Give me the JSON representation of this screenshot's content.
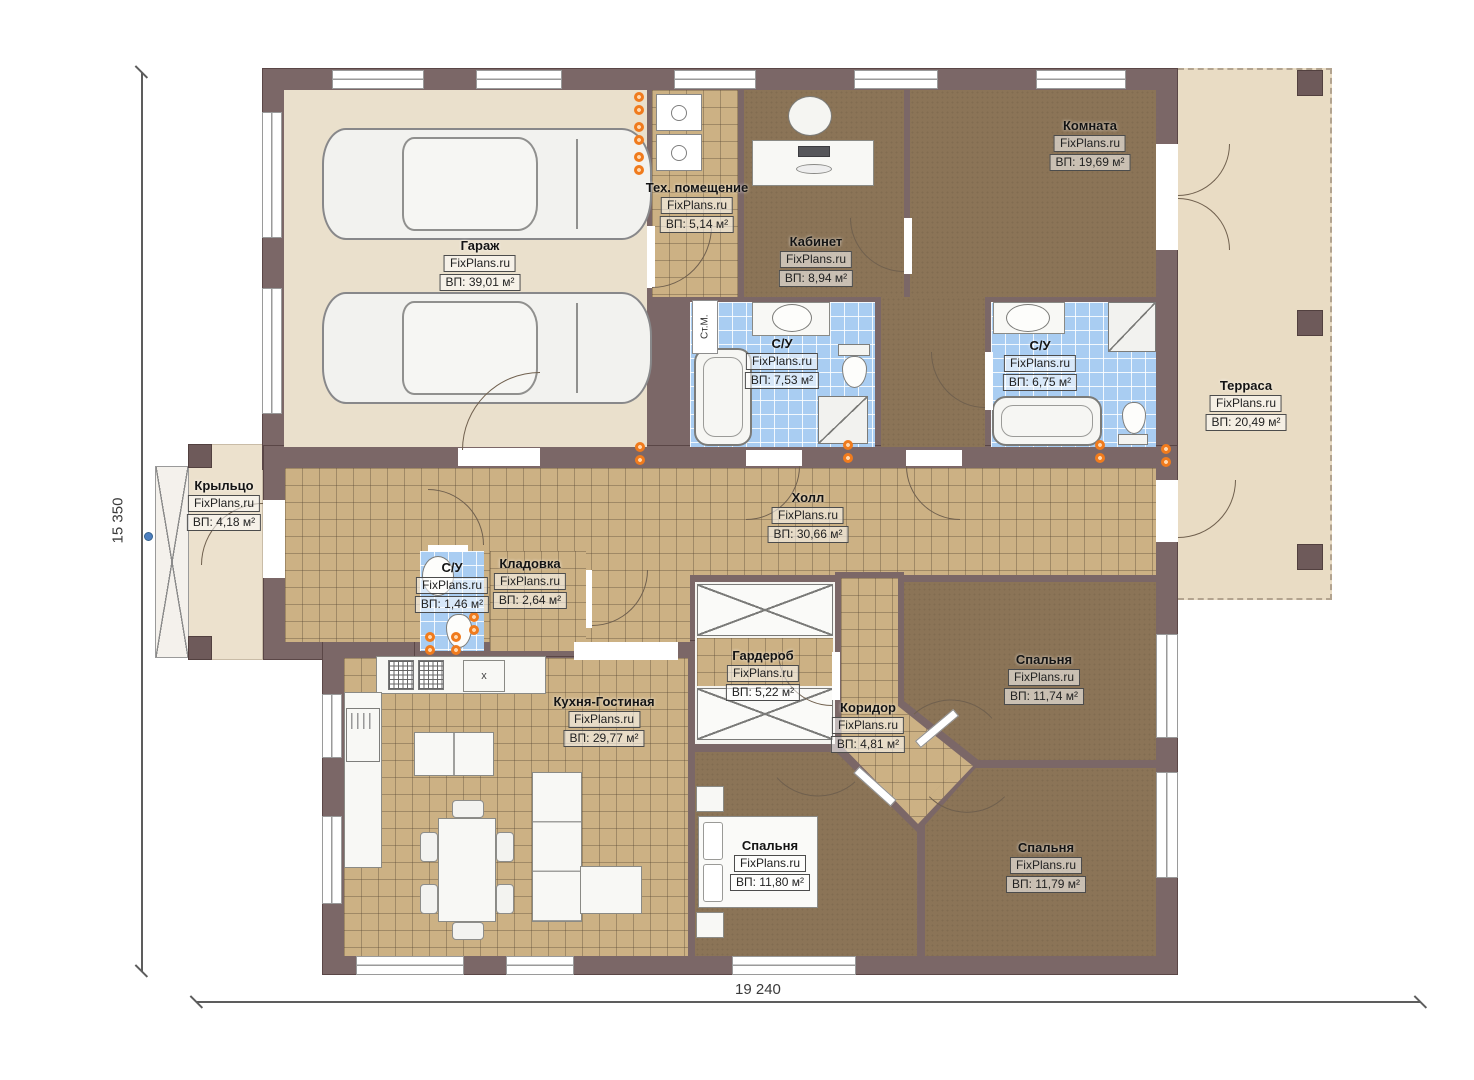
{
  "plan": {
    "brand": "FixPlans.ru",
    "dimensions": {
      "width_mm": "19 240",
      "height_mm": "15 350"
    },
    "rooms": {
      "garage": {
        "name": "Гараж",
        "brand": "FixPlans.ru",
        "area": "ВП: 39,01 м²"
      },
      "tech": {
        "name": "Тех. помещение",
        "brand": "FixPlans.ru",
        "area": "ВП: 5,14 м²"
      },
      "office": {
        "name": "Кабинет",
        "brand": "FixPlans.ru",
        "area": "ВП: 8,94 м²"
      },
      "room": {
        "name": "Комната",
        "brand": "FixPlans.ru",
        "area": "ВП: 19,69 м²"
      },
      "bath_main": {
        "name": "С/У",
        "brand": "FixPlans.ru",
        "area": "ВП: 7,53 м²"
      },
      "bath_second": {
        "name": "С/У",
        "brand": "FixPlans.ru",
        "area": "ВП: 6,75 м²"
      },
      "terrace": {
        "name": "Терраса",
        "brand": "FixPlans.ru",
        "area": "ВП: 20,49 м²"
      },
      "porch": {
        "name": "Крыльцо",
        "brand": "FixPlans.ru",
        "area": "ВП: 4,18 м²"
      },
      "hall": {
        "name": "Холл",
        "brand": "FixPlans.ru",
        "area": "ВП: 30,66 м²"
      },
      "bath_small": {
        "name": "С/У",
        "brand": "FixPlans.ru",
        "area": "ВП: 1,46 м²"
      },
      "storage": {
        "name": "Кладовка",
        "brand": "FixPlans.ru",
        "area": "ВП: 2,64 м²"
      },
      "kitchen_living": {
        "name": "Кухня-Гостиная",
        "brand": "FixPlans.ru",
        "area": "ВП: 29,77 м²"
      },
      "wardrobe": {
        "name": "Гардероб",
        "brand": "FixPlans.ru",
        "area": "ВП: 5,22 м²"
      },
      "corridor": {
        "name": "Коридор",
        "brand": "FixPlans.ru",
        "area": "ВП: 4,81 м²"
      },
      "bedroom_top": {
        "name": "Спальня",
        "brand": "FixPlans.ru",
        "area": "ВП: 11,74 м²"
      },
      "bedroom_left": {
        "name": "Спальня",
        "brand": "FixPlans.ru",
        "area": "ВП: 11,80 м²"
      },
      "bedroom_right": {
        "name": "Спальня",
        "brand": "FixPlans.ru",
        "area": "ВП: 11,79 м²"
      }
    },
    "annotations": {
      "washing_machine": "Ст.М.",
      "sink_mark": "x"
    },
    "colors": {
      "wall": "#7b6767",
      "tile_tan": "#ccb184",
      "floor_dark": "#8b7457",
      "tile_blue": "#a9cdf2",
      "terrace": "#e9dcc4",
      "garage_floor": "#eae0cc",
      "accent_orange": "#f07b1d"
    }
  }
}
